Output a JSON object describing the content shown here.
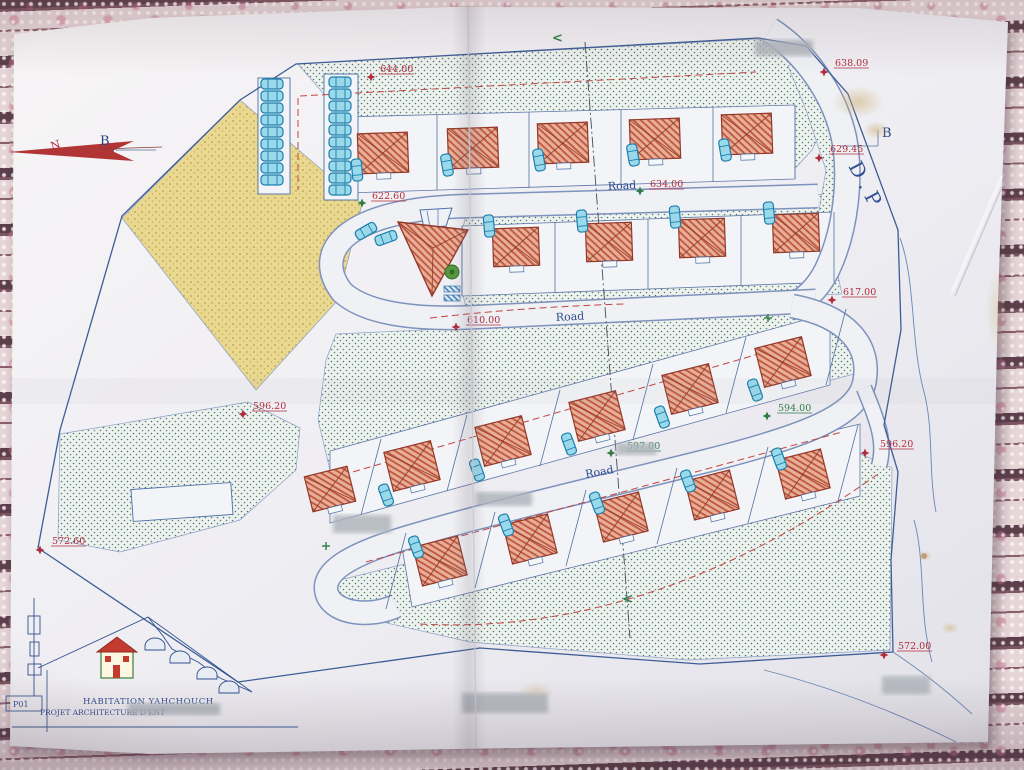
{
  "title_block": {
    "sheet_no": "P01",
    "title": "HABITATION YAHCHOUCH",
    "subtitle": "PROJET ARCHITECTURE D'ENT"
  },
  "labels": {
    "north": "N",
    "section_left": "B",
    "section_right": "B",
    "road_designation": "D.P"
  },
  "plan": {
    "boundary": [
      [
        296,
        64
      ],
      [
        758,
        38
      ],
      [
        806,
        46
      ],
      [
        848,
        94
      ],
      [
        898,
        230
      ],
      [
        901,
        330
      ],
      [
        884,
        425
      ],
      [
        898,
        472
      ],
      [
        891,
        560
      ],
      [
        893,
        652
      ],
      [
        700,
        664
      ],
      [
        480,
        648
      ],
      [
        238,
        682
      ],
      [
        38,
        548
      ],
      [
        60,
        430
      ],
      [
        122,
        216
      ],
      [
        240,
        100
      ]
    ],
    "areas": [
      {
        "name": "green-area-top",
        "fill": "green",
        "pts": [
          [
            298,
            64
          ],
          [
            756,
            39
          ],
          [
            800,
            46
          ],
          [
            838,
            96
          ],
          [
            812,
            150
          ],
          [
            790,
            174
          ],
          [
            782,
            112
          ],
          [
            348,
            122
          ]
        ]
      },
      {
        "name": "green-strip-upper",
        "fill": "green",
        "pts": [
          [
            468,
            206
          ],
          [
            840,
            194
          ],
          [
            846,
            218
          ],
          [
            462,
            232
          ]
        ]
      },
      {
        "name": "green-strip-lower",
        "fill": "green",
        "pts": [
          [
            462,
            290
          ],
          [
            838,
            276
          ],
          [
            842,
            294
          ],
          [
            466,
            308
          ]
        ]
      },
      {
        "name": "green-wedge-right",
        "fill": "green",
        "pts": [
          [
            806,
            54
          ],
          [
            842,
            102
          ],
          [
            848,
            172
          ],
          [
            828,
            252
          ],
          [
            812,
            252
          ],
          [
            826,
            170
          ],
          [
            806,
            110
          ],
          [
            788,
            66
          ]
        ]
      },
      {
        "name": "green-band-middle",
        "fill": "green",
        "pts": [
          [
            336,
            334
          ],
          [
            816,
            312
          ],
          [
            858,
            330
          ],
          [
            862,
            372
          ],
          [
            700,
            414
          ],
          [
            520,
            458
          ],
          [
            380,
            492
          ],
          [
            330,
            470
          ],
          [
            318,
            420
          ],
          [
            326,
            360
          ]
        ]
      },
      {
        "name": "green-area-lower-left",
        "fill": "green",
        "pts": [
          [
            60,
            434
          ],
          [
            248,
            402
          ],
          [
            300,
            428
          ],
          [
            296,
            470
          ],
          [
            240,
            520
          ],
          [
            120,
            552
          ],
          [
            58,
            540
          ]
        ]
      },
      {
        "name": "green-area-bottom",
        "fill": "green",
        "pts": [
          [
            332,
            582
          ],
          [
            856,
            452
          ],
          [
            892,
            468
          ],
          [
            890,
            650
          ],
          [
            688,
            660
          ],
          [
            470,
            642
          ],
          [
            356,
            616
          ]
        ]
      },
      {
        "name": "sand-area",
        "fill": "sand",
        "pts": [
          [
            240,
            100
          ],
          [
            362,
            204
          ],
          [
            338,
            300
          ],
          [
            256,
            390
          ],
          [
            122,
            218
          ]
        ]
      }
    ],
    "white_bands": [
      [
        [
          345,
          117
        ],
        [
          795,
          105
        ],
        [
          795,
          179
        ],
        [
          345,
          193
        ]
      ],
      [
        [
          462,
          226
        ],
        [
          834,
          212
        ],
        [
          834,
          282
        ],
        [
          462,
          296
        ]
      ],
      [
        [
          330,
          451
        ],
        [
          830,
          313
        ],
        [
          830,
          385
        ],
        [
          330,
          523
        ]
      ],
      [
        [
          400,
          535
        ],
        [
          860,
          424
        ],
        [
          860,
          496
        ],
        [
          412,
          607
        ]
      ]
    ],
    "lots": [
      [
        258,
        78,
        32,
        116,
        0
      ],
      [
        324,
        74,
        34,
        126,
        0
      ],
      [
        132,
        486,
        100,
        32,
        -4
      ]
    ],
    "roads": [
      {
        "d": "M 770,30 C 804,52 834,92 844,138 C 851,175 847,228 827,270 C 817,290 804,301 789,308",
        "w": 24
      },
      {
        "d": "M 818,196 L 470,206 C 348,208 310,250 342,292 C 368,316 425,320 478,317 L 816,301",
        "w": 22
      },
      {
        "d": "M 792,306 C 850,317 872,348 864,384 C 856,416 806,436 706,461 C 606,486 484,514 402,539 C 350,555 320,572 327,594 C 334,614 370,618 396,606",
        "w": 22
      },
      {
        "d": "M 864,388 C 877,420 886,442 879,466",
        "w": 14
      }
    ],
    "blue_lines": [
      [
        345,
        117,
        345,
        193
      ],
      [
        437,
        115,
        437,
        190
      ],
      [
        529,
        112,
        529,
        188
      ],
      [
        621,
        110,
        621,
        185
      ],
      [
        713,
        108,
        713,
        182
      ],
      [
        795,
        105,
        795,
        179
      ],
      [
        462,
        226,
        462,
        296
      ],
      [
        555,
        222,
        555,
        292
      ],
      [
        648,
        219,
        648,
        289
      ],
      [
        741,
        215,
        741,
        285
      ],
      [
        834,
        212,
        834,
        282
      ],
      [
        746,
        337,
        726,
        413
      ],
      [
        653,
        364,
        633,
        440
      ],
      [
        560,
        390,
        540,
        466
      ],
      [
        467,
        415,
        447,
        491
      ],
      [
        381,
        439,
        361,
        515
      ],
      [
        846,
        309,
        826,
        385
      ],
      [
        768,
        447,
        748,
        523
      ],
      [
        677,
        468,
        657,
        544
      ],
      [
        586,
        490,
        566,
        566
      ],
      [
        495,
        512,
        475,
        588
      ],
      [
        858,
        425,
        838,
        501
      ],
      [
        406,
        533,
        386,
        609
      ],
      [
        116,
        150,
        156,
        150
      ],
      [
        116,
        142,
        116,
        150
      ],
      [
        840,
        146,
        878,
        146
      ],
      [
        878,
        130,
        878,
        146
      ]
    ],
    "contours": [
      "M 900,238 C 916,282 910,340 924,392 C 934,430 928,470 936,512",
      "M 914,520 C 926,562 918,612 932,662",
      "M 893,652 C 920,670 948,692 972,714",
      "M 764,670 C 842,690 904,716 956,742"
    ],
    "red_dashed": [
      "M 300,96 L 756,72",
      "M 298,98 L 298,190",
      "M 430,318 C 500,310 560,306 624,304",
      "M 332,478 L 786,346",
      "M 366,562 L 842,432",
      "M 420,624 C 600,634 758,560 878,474"
    ],
    "section_lines": [
      [
        585,
        42,
        630,
        638
      ],
      [
        36,
        151,
        114,
        151
      ]
    ],
    "houses": [
      [
        383,
        153,
        50,
        40,
        -2
      ],
      [
        473,
        148,
        50,
        40,
        -2
      ],
      [
        563,
        143,
        50,
        40,
        -2
      ],
      [
        655,
        139,
        50,
        40,
        -2
      ],
      [
        747,
        134,
        50,
        40,
        -2
      ],
      [
        516,
        247,
        46,
        38,
        -2
      ],
      [
        609,
        242,
        46,
        38,
        -2
      ],
      [
        702,
        238,
        46,
        38,
        -2
      ],
      [
        796,
        233,
        46,
        38,
        -2
      ],
      [
        783,
        362,
        48,
        40,
        -14
      ],
      [
        690,
        389,
        48,
        40,
        -14
      ],
      [
        597,
        416,
        48,
        40,
        -14
      ],
      [
        503,
        441,
        48,
        40,
        -14
      ],
      [
        412,
        466,
        48,
        40,
        -14
      ],
      [
        330,
        489,
        44,
        36,
        -14
      ],
      [
        803,
        474,
        46,
        40,
        -14
      ],
      [
        712,
        495,
        46,
        40,
        -14
      ],
      [
        621,
        517,
        46,
        40,
        -14
      ],
      [
        530,
        539,
        46,
        40,
        -14
      ],
      [
        440,
        561,
        46,
        40,
        -14
      ]
    ],
    "cars": [
      [
        272,
        84,
        0
      ],
      [
        272,
        96,
        0
      ],
      [
        272,
        108,
        0
      ],
      [
        272,
        120,
        0
      ],
      [
        272,
        132,
        0
      ],
      [
        272,
        144,
        0
      ],
      [
        272,
        156,
        0
      ],
      [
        272,
        168,
        0
      ],
      [
        272,
        180,
        0
      ],
      [
        340,
        82,
        0
      ],
      [
        340,
        94,
        0
      ],
      [
        340,
        106,
        0
      ],
      [
        340,
        118,
        0
      ],
      [
        340,
        130,
        0
      ],
      [
        340,
        142,
        0
      ],
      [
        340,
        154,
        0
      ],
      [
        340,
        166,
        0
      ],
      [
        340,
        178,
        0
      ],
      [
        340,
        190,
        0
      ],
      [
        366,
        231,
        -30
      ],
      [
        386,
        238,
        -20
      ],
      [
        357,
        170,
        85
      ],
      [
        447,
        165,
        80
      ],
      [
        539,
        160,
        80
      ],
      [
        633,
        155,
        80
      ],
      [
        725,
        150,
        80
      ],
      [
        489,
        226,
        85
      ],
      [
        582,
        221,
        85
      ],
      [
        675,
        217,
        85
      ],
      [
        769,
        213,
        85
      ],
      [
        755,
        390,
        70
      ],
      [
        662,
        417,
        70
      ],
      [
        569,
        444,
        70
      ],
      [
        477,
        470,
        70
      ],
      [
        386,
        495,
        70
      ],
      [
        779,
        459,
        70
      ],
      [
        688,
        481,
        70
      ],
      [
        597,
        503,
        70
      ],
      [
        506,
        525,
        70
      ],
      [
        416,
        547,
        70
      ]
    ],
    "elevation_markers": [
      {
        "v": "644.00",
        "x": 380,
        "y": 72,
        "mx": 371,
        "my": 77,
        "c": "r",
        "mc": "r"
      },
      {
        "v": "638.09",
        "x": 835,
        "y": 66,
        "mx": 824,
        "my": 72,
        "c": "r",
        "mc": "r"
      },
      {
        "v": "629.45",
        "x": 830,
        "y": 152,
        "mx": 819,
        "my": 158,
        "c": "r",
        "mc": "r"
      },
      {
        "v": "634.00",
        "x": 650,
        "y": 187,
        "mx": 640,
        "my": 191,
        "c": "r",
        "mc": "g"
      },
      {
        "v": "622.60",
        "x": 372,
        "y": 199,
        "mx": 362,
        "my": 203,
        "c": "r",
        "mc": "g"
      },
      {
        "v": "617.00",
        "x": 843,
        "y": 295,
        "mx": 832,
        "my": 300,
        "c": "r",
        "mc": "r"
      },
      {
        "v": "610.00",
        "x": 467,
        "y": 323,
        "mx": 456,
        "my": 327,
        "c": "r",
        "mc": "r"
      },
      {
        "v": "596.20",
        "x": 253,
        "y": 409,
        "mx": 243,
        "my": 414,
        "c": "r",
        "mc": "r"
      },
      {
        "v": "594.00",
        "x": 778,
        "y": 411,
        "mx": 767,
        "my": 416,
        "c": "g",
        "mc": "g"
      },
      {
        "v": "597.00",
        "x": 627,
        "y": 449,
        "mx": 611,
        "my": 453,
        "c": "g",
        "mc": "g"
      },
      {
        "v": "596.20",
        "x": 880,
        "y": 447,
        "mx": 865,
        "my": 453,
        "c": "r",
        "mc": "r"
      },
      {
        "v": "572.60",
        "x": 52,
        "y": 544,
        "mx": 40,
        "my": 550,
        "c": "r",
        "mc": "r"
      },
      {
        "v": "572.00",
        "x": 898,
        "y": 649,
        "mx": 884,
        "my": 655,
        "c": "r",
        "mc": "r"
      }
    ],
    "road_labels": [
      {
        "t": "Road",
        "x": 608,
        "y": 190,
        "r": -3
      },
      {
        "t": "Road",
        "x": 556,
        "y": 321,
        "r": -3
      },
      {
        "t": "Road",
        "x": 586,
        "y": 478,
        "r": -10
      }
    ],
    "green_marks": [
      [
        768,
        318
      ],
      [
        326,
        546
      ]
    ],
    "section_arrows": [
      {
        "x": 552,
        "y": 42,
        "r": 0
      },
      {
        "x": 622,
        "y": 603,
        "r": 0
      }
    ],
    "redactions": [
      [
        755,
        40,
        58,
        16
      ],
      [
        128,
        703,
        92,
        12
      ],
      [
        462,
        693,
        86,
        20
      ],
      [
        882,
        676,
        48,
        18
      ],
      [
        333,
        515,
        58,
        18
      ],
      [
        476,
        492,
        56,
        14
      ],
      [
        616,
        443,
        40,
        12
      ]
    ]
  }
}
